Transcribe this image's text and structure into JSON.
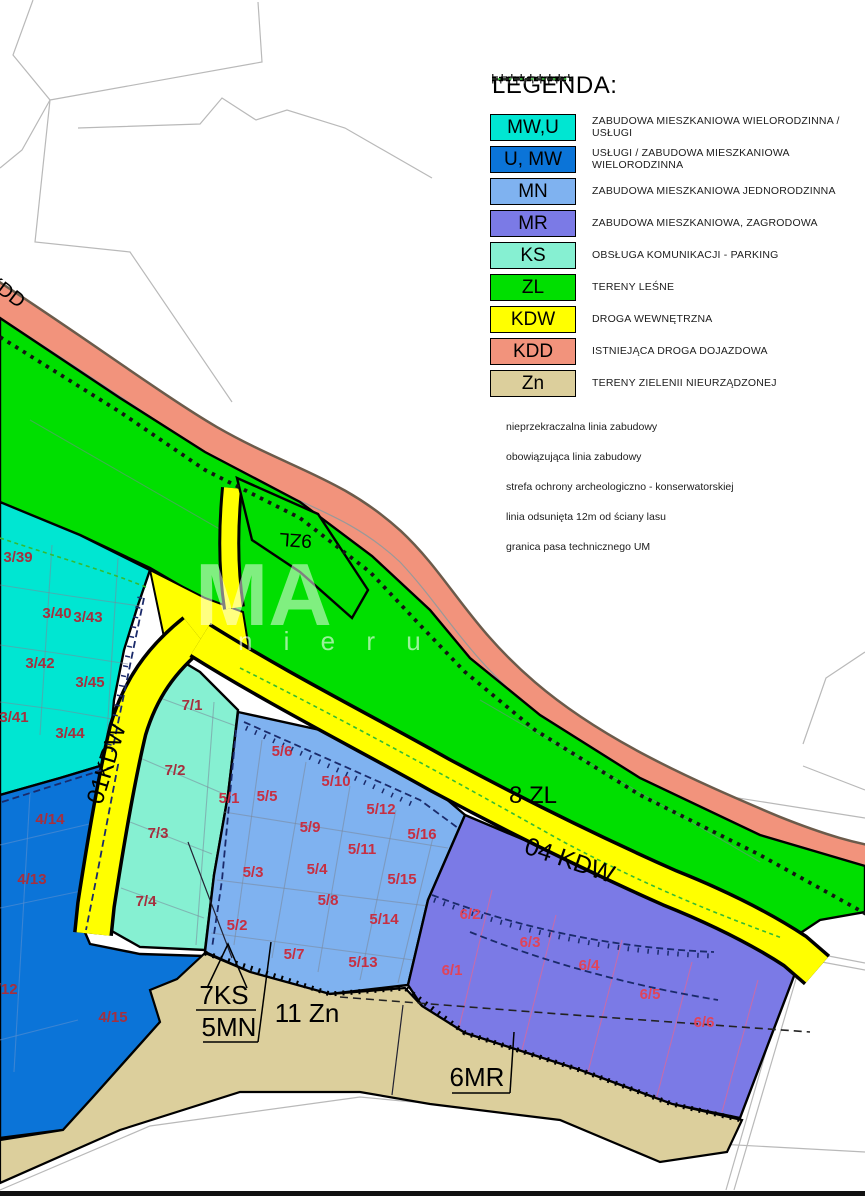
{
  "legend": {
    "title": "LEGENDA:",
    "items": [
      {
        "code": "MW,U",
        "color": "#00e6d2",
        "label": "ZABUDOWA MIESZKANIOWA WIELORODZINNA / USŁUGI"
      },
      {
        "code": "U, MW",
        "color": "#0b74d8",
        "label": "USŁUGI / ZABUDOWA MIESZKANIOWA WIELORODZINNA"
      },
      {
        "code": "MN",
        "color": "#7fb2f0",
        "label": "ZABUDOWA MIESZKANIOWA JEDNORODZINNA"
      },
      {
        "code": "MR",
        "color": "#7b7ae6",
        "label": "ZABUDOWA MIESZKANIOWA, ZAGRODOWA"
      },
      {
        "code": "KS",
        "color": "#86f0d2",
        "label": "OBSŁUGA KOMUNIKACJI - PARKING"
      },
      {
        "code": "ZL",
        "color": "#00df00",
        "label": "TERENY LEŚNE"
      },
      {
        "code": "KDW",
        "color": "#ffff00",
        "label": "DROGA WEWNĘTRZNA"
      },
      {
        "code": "KDD",
        "color": "#f2937c",
        "label": "ISTNIEJĄCA DROGA DOJAZDOWA"
      },
      {
        "code": "Zn",
        "color": "#dccf9c",
        "label": "TERENY ZIELENII NIEURZĄDZONEJ"
      }
    ],
    "lines": [
      {
        "type": "building-limit",
        "label": "nieprzekraczalna linia zabudowy"
      },
      {
        "type": "building-oblig",
        "label": "obowiązująca linia zabudowy"
      },
      {
        "type": "archeo",
        "label": "strefa ochrony archeologiczno - konserwatorskiej"
      },
      {
        "type": "forest-offset",
        "label": "linia odsunięta 12m od ściany lasu"
      },
      {
        "type": "tech-strip",
        "label": "granica pasa technicznego UM"
      }
    ]
  },
  "map": {
    "colors": {
      "cadastral": "#b9b9b9",
      "division_gray": "#7a8699",
      "division_blue": "#5a8fd0",
      "division_pink": "#d4699f",
      "building_line": "#1a2a6a",
      "archeo": "#141414",
      "forest_line": "#33bb33",
      "road_edge": "#6b5b4b",
      "road_inner": "#999999",
      "outline": "#000000",
      "label": "#000000"
    },
    "parcel_colors": {
      "3": "#a5303e",
      "4": "#a5303e",
      "7": "#a5303e",
      "5": "#c62f42",
      "6": "#e0445a"
    },
    "zone_labels": [
      {
        "text": "KDD",
        "x": 2,
        "y": 296,
        "rot": 37,
        "size": 20
      },
      {
        "text": "9ZL",
        "x": 296,
        "y": 534,
        "rot": 184,
        "size": 19
      },
      {
        "text": "01KDW",
        "x": 114,
        "y": 766,
        "rot": -73,
        "size": 24
      },
      {
        "text": "8 ZL",
        "x": 533,
        "y": 803,
        "rot": 0,
        "size": 24
      },
      {
        "text": "04 KDW",
        "x": 567,
        "y": 868,
        "rot": 19,
        "size": 25
      },
      {
        "text": "7KS",
        "x": 224,
        "y": 1004,
        "rot": 0,
        "size": 26
      },
      {
        "text": "5MN",
        "x": 229,
        "y": 1036,
        "rot": 0,
        "size": 26
      },
      {
        "text": "11 Zn",
        "x": 307,
        "y": 1022,
        "rot": 0,
        "size": 26
      },
      {
        "text": "6MR",
        "x": 477,
        "y": 1086,
        "rot": 0,
        "size": 26
      }
    ],
    "parcels": [
      {
        "t": "3/39",
        "x": 18,
        "y": 562
      },
      {
        "t": "3/40",
        "x": 57,
        "y": 618
      },
      {
        "t": "3/43",
        "x": 88,
        "y": 622
      },
      {
        "t": "3/42",
        "x": 40,
        "y": 668
      },
      {
        "t": "3/45",
        "x": 90,
        "y": 687
      },
      {
        "t": "3/41",
        "x": 14,
        "y": 722
      },
      {
        "t": "3/44",
        "x": 70,
        "y": 738
      },
      {
        "t": "4/14",
        "x": 50,
        "y": 824
      },
      {
        "t": "4/13",
        "x": 32,
        "y": 884
      },
      {
        "t": "4/12",
        "x": 3,
        "y": 994
      },
      {
        "t": "4/15",
        "x": 113,
        "y": 1022
      },
      {
        "t": "7/1",
        "x": 192,
        "y": 710
      },
      {
        "t": "7/2",
        "x": 175,
        "y": 775
      },
      {
        "t": "7/3",
        "x": 158,
        "y": 838
      },
      {
        "t": "7/4",
        "x": 146,
        "y": 906
      },
      {
        "t": "5/1",
        "x": 229,
        "y": 803
      },
      {
        "t": "5/2",
        "x": 237,
        "y": 930
      },
      {
        "t": "5/3",
        "x": 253,
        "y": 877
      },
      {
        "t": "5/4",
        "x": 317,
        "y": 874
      },
      {
        "t": "5/5",
        "x": 267,
        "y": 801
      },
      {
        "t": "5/6",
        "x": 282,
        "y": 756
      },
      {
        "t": "5/7",
        "x": 294,
        "y": 959
      },
      {
        "t": "5/8",
        "x": 328,
        "y": 905
      },
      {
        "t": "5/9",
        "x": 310,
        "y": 832
      },
      {
        "t": "5/10",
        "x": 336,
        "y": 786
      },
      {
        "t": "5/11",
        "x": 362,
        "y": 854
      },
      {
        "t": "5/12",
        "x": 381,
        "y": 814
      },
      {
        "t": "5/13",
        "x": 363,
        "y": 967
      },
      {
        "t": "5/14",
        "x": 384,
        "y": 924
      },
      {
        "t": "5/15",
        "x": 402,
        "y": 884
      },
      {
        "t": "5/16",
        "x": 422,
        "y": 839
      },
      {
        "t": "6/1",
        "x": 452,
        "y": 975
      },
      {
        "t": "6/2",
        "x": 470,
        "y": 919
      },
      {
        "t": "6/3",
        "x": 530,
        "y": 947
      },
      {
        "t": "6/4",
        "x": 589,
        "y": 970
      },
      {
        "t": "6/5",
        "x": 650,
        "y": 999
      },
      {
        "t": "6/6",
        "x": 704,
        "y": 1027
      }
    ],
    "watermark": {
      "big": "MA",
      "small": "n i e r u"
    }
  }
}
